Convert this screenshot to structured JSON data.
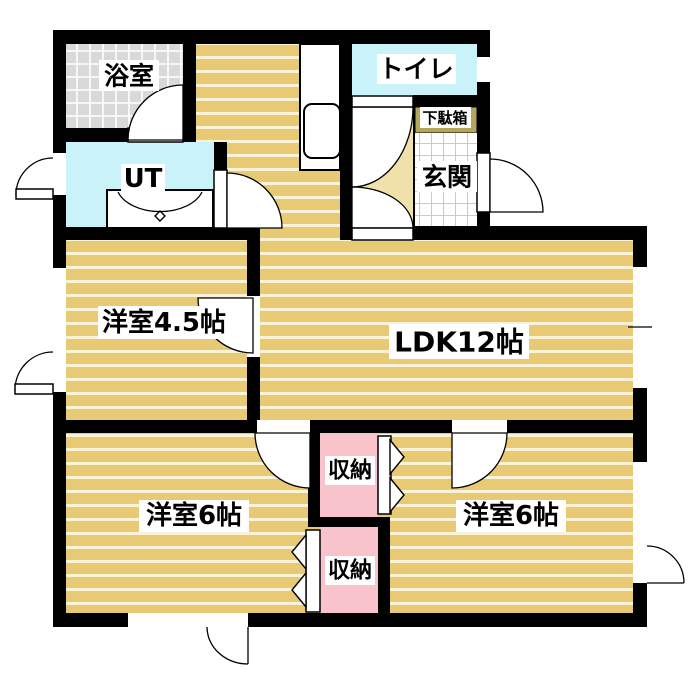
{
  "title": "apartment-floor-plan",
  "colors": {
    "wall": "#000000",
    "floor": "#e8ca74",
    "floor_stripe": "#fbf3d8",
    "fan": "#f0e1ab",
    "water": "#c9f3f8",
    "closet": "#f8c3cb",
    "bath_tile": "#d9d9d9",
    "bath_tile_line": "#ffffff",
    "genkan_tile_line": "#c9c9d4",
    "shoe_cabinet": "#b3a75c",
    "label_bg": "#ffffff",
    "label_text": "#000000"
  },
  "labels": {
    "bath": "浴室",
    "utility": "UT",
    "toilet": "トイレ",
    "shoe_cabinet": "下駄箱",
    "entrance": "玄関",
    "western_room_45": "洋室4.5帖",
    "ldk": "LDK12帖",
    "storage_upper": "収納",
    "storage_lower": "収納",
    "western_room_6_left": "洋室6帖",
    "western_room_6_right": "洋室6帖"
  }
}
